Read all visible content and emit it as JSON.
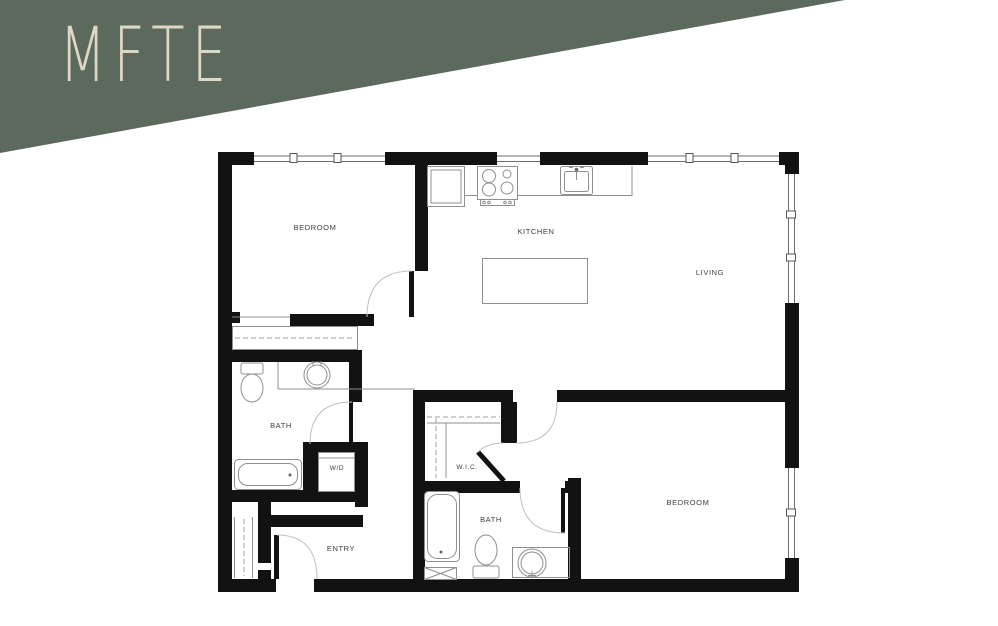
{
  "banner": {
    "label": "MFTE"
  },
  "colors": {
    "banner_green": "#5c6a5e",
    "banner_text": "#ddd7c4",
    "wall": "#121212",
    "thin_line": "#8f8f8f",
    "dash_line": "#b2b2b2",
    "arc_line": "#c0c0c0",
    "label_text": "#3d3d3d",
    "background": "#ffffff"
  },
  "floor_plan": {
    "rooms": [
      {
        "name": "bedroom-1",
        "label": "BEDROOM"
      },
      {
        "name": "kitchen",
        "label": "KITCHEN"
      },
      {
        "name": "living",
        "label": "LIVING"
      },
      {
        "name": "bath-1",
        "label": "BATH"
      },
      {
        "name": "laundry-closet",
        "label": "W/D"
      },
      {
        "name": "walk-in-closet",
        "label": "W.I.C."
      },
      {
        "name": "bath-2",
        "label": "BATH"
      },
      {
        "name": "bedroom-2",
        "label": "BEDROOM"
      },
      {
        "name": "entry",
        "label": "ENTRY"
      }
    ]
  }
}
